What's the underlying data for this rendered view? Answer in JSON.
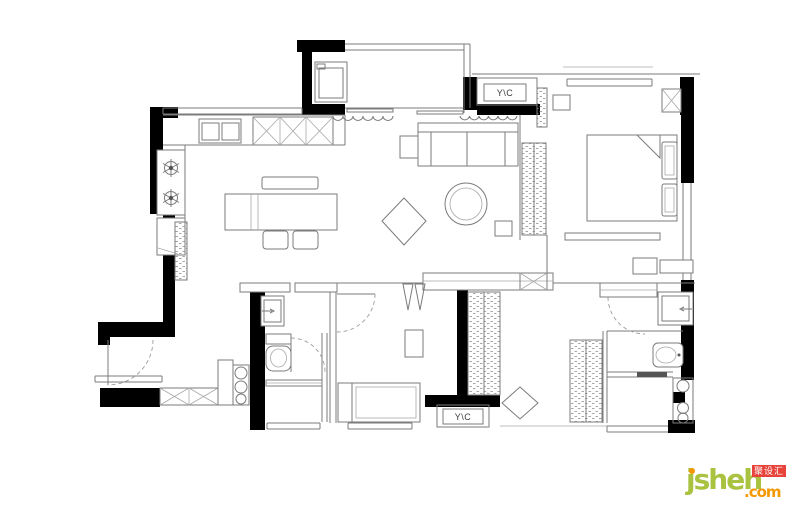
{
  "canvas": {
    "width": 800,
    "height": 508,
    "background": "#ffffff"
  },
  "plan": {
    "type": "apartment-floor-plan",
    "ac_labels": {
      "top": "Y\\C",
      "bottom": "Y\\C"
    },
    "colors": {
      "wall": "#000000",
      "line": "#7b7b7b",
      "light_line": "#a8a8a8"
    }
  },
  "watermark": {
    "brand": "jsheh",
    "tld": ".com",
    "badge": "聚设汇",
    "colors": {
      "brand_green": "#a9c23f",
      "tld_orange": "#f39800",
      "badge_red": "#e8433a"
    }
  }
}
